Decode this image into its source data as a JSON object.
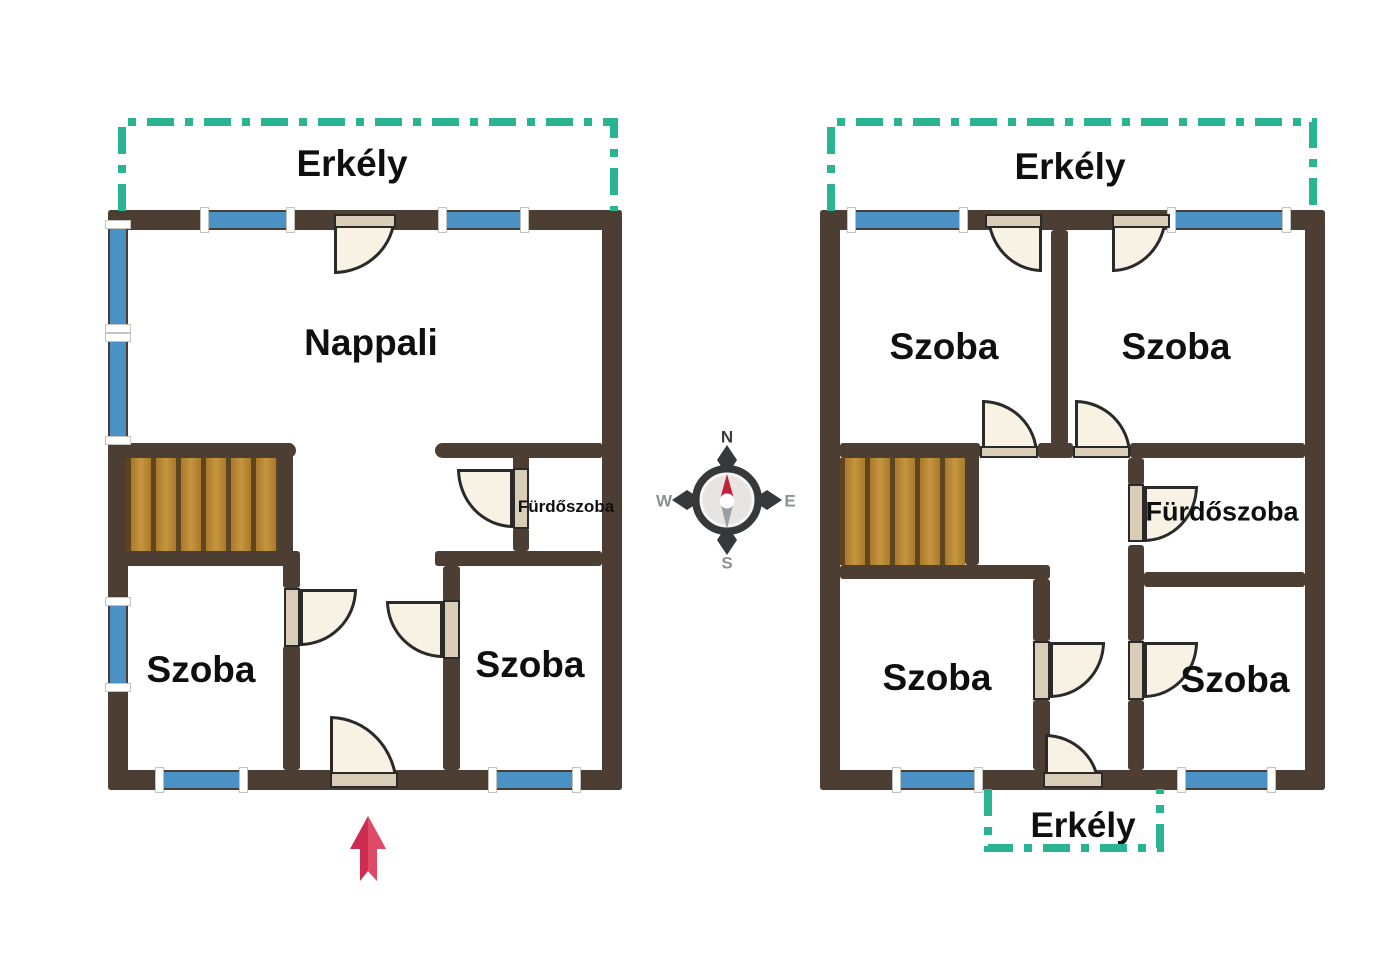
{
  "floor1": {
    "balcony": "Erkély",
    "living_room": "Nappali",
    "bathroom": "Fürdőszoba",
    "room_bottom_left": "Szoba",
    "room_bottom_right": "Szoba"
  },
  "floor2": {
    "balcony_top": "Erkély",
    "room_top_left": "Szoba",
    "room_top_right": "Szoba",
    "bathroom": "Fürdőszoba",
    "room_bottom_left": "Szoba",
    "room_bottom_right": "Szoba",
    "balcony_bottom": "Erkély"
  },
  "compass": {
    "north": "N",
    "east": "E",
    "south": "S",
    "west": "W"
  },
  "colors": {
    "wall": "#4c3e33",
    "window": "#4a92c6",
    "window_sill": "#ffffff",
    "balcony_dash": "#2bb492",
    "door_fill": "#f8f2e5",
    "door_leaf": "#d9cdb8",
    "door_outline": "#2a2a2a",
    "stair_plank": "#b0812f",
    "stair_plank_dark": "#5e4520",
    "entrance_arrow": "#d13354",
    "compass_needle_north": "#c2203d",
    "compass_needle_south": "#9aa0a2",
    "compass_ring": "#35393b",
    "label_text": "#0f0f0f"
  }
}
